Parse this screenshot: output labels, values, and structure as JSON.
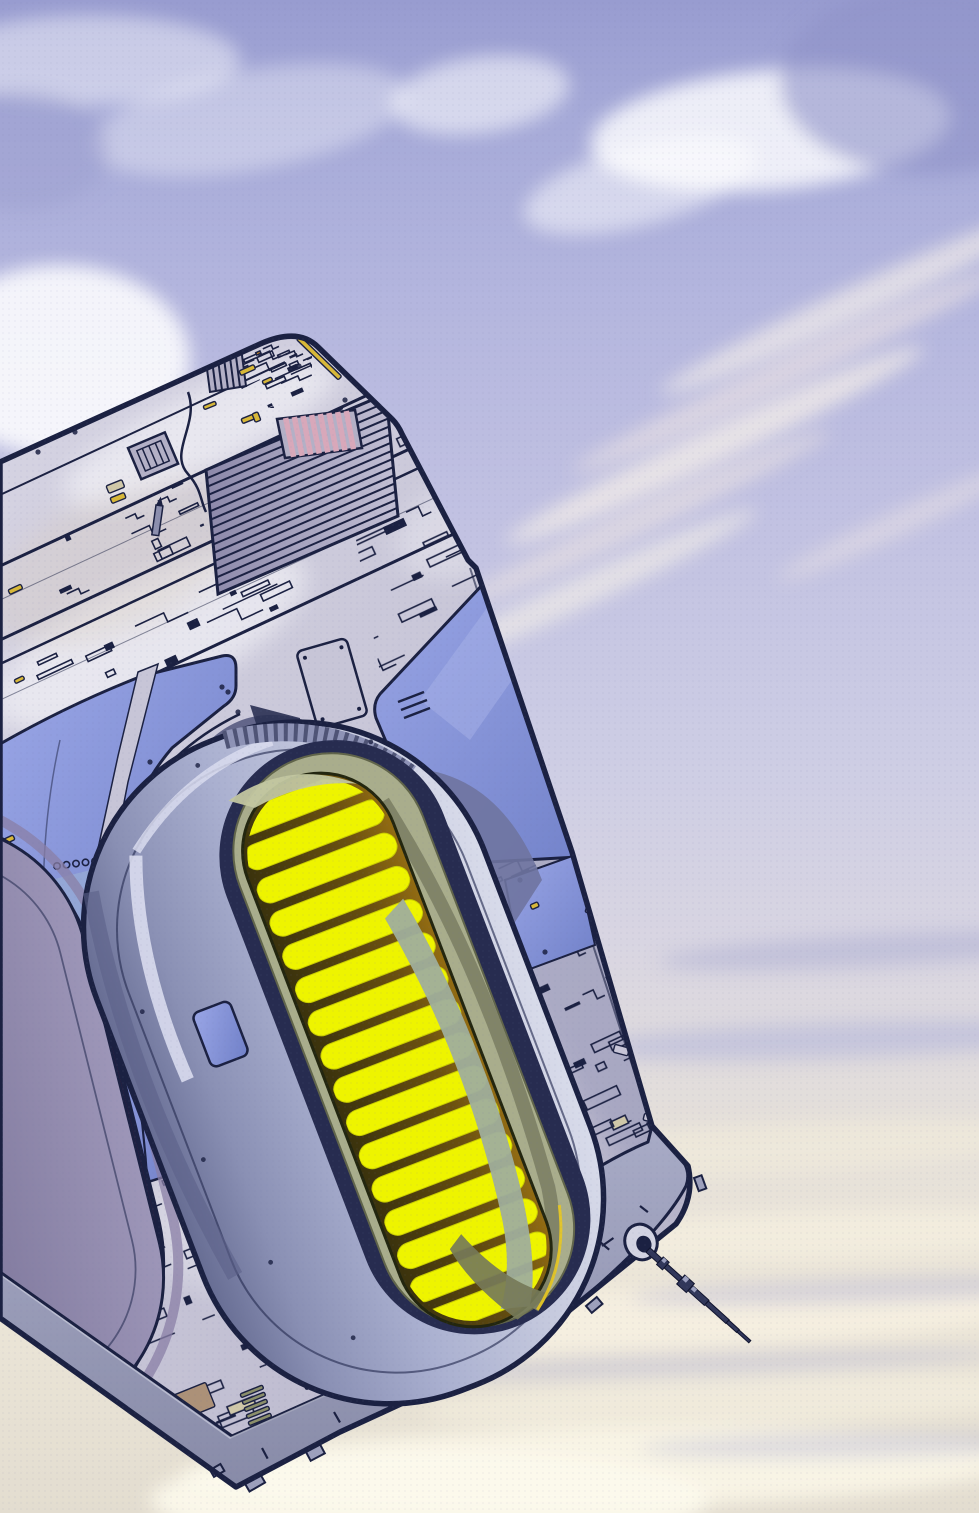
{
  "meta": {
    "title": "Comic splash illustration: massive greebled starship hull with glowing engine nacelles drifting in a lavender cloudy sky",
    "style": "printed-comic-halftone",
    "width": 979,
    "height": 1513
  },
  "palette": {
    "outline": "#1b2142",
    "navy": "#232a52",
    "hull_base": "#c7c5d7",
    "hull_light": "#d6d4e3",
    "hull_dark": "#b3b0c6",
    "side_face": "#9da0bc",
    "side_dark": "#8b8ea9",
    "blue_hi": "#9aa6e6",
    "blue_lo": "#7080c8",
    "teal_patch": "#9fb8d4",
    "pod_shell_l": "#676d93",
    "pod_shell_m": "#aab0d0",
    "pod_shell_r": "#d8dbea",
    "trim": "#d9dcee",
    "cavity": "#272c50",
    "olive": "#a9ad8c",
    "olive_dark": "#767a58",
    "sage": "#c2c6a0",
    "sage_grey": "#9fae9c",
    "gap_dark": "#3a320d",
    "gap_orange": "#936c12",
    "slat_yellow": "#eef400",
    "slat_edge": "#c9cc00",
    "lp_maroon": "#6f2136",
    "lp_gap": "#54101c",
    "lp_shell_1": "#6d6890",
    "lp_shell_2": "#9d96b8",
    "lp_band": "#8a7fa6",
    "slat_gold_1": "#f6cf2a",
    "slat_gold_2": "#e08a14",
    "mauve_1": "#b05878",
    "mauve_2": "#7e3560",
    "gold": "#d8b838",
    "tan": "#cfc7a8",
    "tan_brown": "#ac9178",
    "orange": "#dd8f1c",
    "magenta": "#c535c5",
    "pink_vent": "#d8a8ba",
    "olive_vent": "#8b8f6a",
    "sky_top": "#989cd0",
    "cream": "#efe9d8",
    "glint_yellow": "#e8c820"
  },
  "sky": {
    "gradient": [
      [
        "0",
        "#989cd0"
      ],
      [
        "0.08",
        "#a6aad8"
      ],
      [
        "0.2",
        "#b4b6de"
      ],
      [
        "0.35",
        "#c2c2e2"
      ],
      [
        "0.5",
        "#cdcde4"
      ],
      [
        "0.62",
        "#d8d5e2"
      ],
      [
        "0.74",
        "#e4dfda"
      ],
      [
        "0.85",
        "#ece6d8"
      ],
      [
        "1",
        "#e3ddd0"
      ]
    ],
    "clouds": [
      [
        90,
        60,
        150,
        45,
        0,
        "#ffffff",
        0.45
      ],
      [
        250,
        120,
        160,
        50,
        -10,
        "#ffffff",
        0.35
      ],
      [
        480,
        95,
        90,
        38,
        -8,
        "#ffffff",
        0.55
      ],
      [
        770,
        130,
        180,
        60,
        -5,
        "#ffffff",
        0.8
      ],
      [
        640,
        185,
        120,
        40,
        -15,
        "#ffffff",
        0.5
      ],
      [
        60,
        360,
        130,
        95,
        0,
        "#ffffff",
        0.85
      ],
      [
        160,
        560,
        200,
        130,
        0,
        "#ffffff",
        0.9
      ],
      [
        40,
        720,
        180,
        140,
        0,
        "#ffffff",
        0.95
      ],
      [
        930,
        80,
        150,
        95,
        0,
        "#8f93c8",
        0.6
      ],
      [
        20,
        150,
        90,
        60,
        0,
        "#9da0d0",
        0.5
      ],
      [
        860,
        300,
        220,
        16,
        -25,
        "#f4eeea",
        0.7
      ],
      [
        790,
        370,
        240,
        14,
        -25,
        "#f1e7e4",
        0.6
      ],
      [
        715,
        445,
        230,
        17,
        -25,
        "#f6efe8",
        0.75
      ],
      [
        640,
        520,
        210,
        13,
        -25,
        "#efe6e2",
        0.6
      ],
      [
        575,
        595,
        200,
        15,
        -25,
        "#f4efe8",
        0.65
      ],
      [
        905,
        520,
        140,
        12,
        -25,
        "#eee6e6",
        0.5
      ],
      [
        880,
        950,
        220,
        16,
        -3,
        "#aeb0d4",
        0.55
      ],
      [
        840,
        1040,
        260,
        18,
        -2,
        "#b6b7da",
        0.6
      ],
      [
        760,
        1150,
        300,
        26,
        -3,
        "#efe9da",
        0.85
      ],
      [
        820,
        1235,
        280,
        24,
        -2,
        "#f3edde",
        0.9
      ],
      [
        650,
        1320,
        380,
        30,
        -2,
        "#f5efe0",
        0.95
      ],
      [
        750,
        1400,
        330,
        26,
        -2,
        "#f1ebdc",
        0.9
      ],
      [
        600,
        1468,
        420,
        40,
        -1,
        "#f9f4e6",
        0.95
      ],
      [
        870,
        1290,
        240,
        12,
        -2,
        "#b7b7d4",
        0.5
      ],
      [
        700,
        1365,
        300,
        12,
        -2,
        "#c0c0d8",
        0.5
      ],
      [
        860,
        1445,
        220,
        12,
        -1,
        "#bcbcd4",
        0.45
      ],
      [
        430,
        1500,
        280,
        50,
        0,
        "#fdf9ec",
        0.9
      ]
    ]
  },
  "ship": {
    "tilt_deg": -25,
    "sheens": [
      [
        150,
        640,
        170,
        60,
        -25,
        "#ffffff",
        0.5
      ],
      [
        85,
        1075,
        45,
        120,
        -20,
        "#ffffff",
        0.45
      ],
      [
        330,
        900,
        160,
        80,
        -25,
        "#9093bb",
        0.32
      ],
      [
        120,
        560,
        140,
        70,
        -25,
        "#d8cdc2",
        0.38
      ],
      [
        200,
        432,
        150,
        38,
        -25,
        "#ffffff",
        0.5
      ],
      [
        590,
        990,
        60,
        220,
        -24,
        "#8487ad",
        0.35
      ],
      [
        260,
        1200,
        120,
        90,
        -22,
        "#eceaf2",
        0.4
      ],
      [
        480,
        520,
        90,
        50,
        -25,
        "#ffffff",
        0.3
      ]
    ],
    "louver": {
      "pts": [
        [
          206,
          470
        ],
        [
          386,
          394
        ],
        [
          398,
          516
        ],
        [
          218,
          594
        ]
      ],
      "ribs": 15
    },
    "pink_vent": {
      "pts": [
        [
          277,
          419
        ],
        [
          355,
          410
        ],
        [
          362,
          448
        ],
        [
          285,
          458
        ]
      ],
      "stripes": 9,
      "stroke_w": 5.5
    },
    "corner_grill": {
      "pts": [
        [
          204,
          346
        ],
        [
          240,
          340
        ],
        [
          246,
          386
        ],
        [
          210,
          392
        ]
      ],
      "stripes": 6
    },
    "greeble_fields": [
      {
        "name": "corner-cluster",
        "clip": [
          [
            222,
            338
          ],
          [
            312,
            338
          ],
          [
            312,
            408
          ],
          [
            222,
            408
          ]
        ],
        "bbox": [
          222,
          338,
          90,
          70
        ],
        "angle": -24,
        "n": 28,
        "seed": 7,
        "scale": 0.55,
        "accent_p": 0.12
      },
      {
        "name": "trench-a",
        "clip": [
          [
            0,
            566
          ],
          [
            430,
            366
          ],
          [
            446,
            432
          ],
          [
            0,
            640
          ]
        ],
        "bbox": [
          0,
          350,
          460,
          300
        ],
        "angle": -25,
        "n": 120,
        "seed": 11,
        "scale": 0.8,
        "accent_p": 0.04
      },
      {
        "name": "trench-b",
        "clip": [
          [
            0,
            664
          ],
          [
            470,
            444
          ],
          [
            520,
            503
          ],
          [
            0,
            746
          ]
        ],
        "bbox": [
          0,
          430,
          530,
          330
        ],
        "angle": -25,
        "n": 115,
        "seed": 23,
        "scale": 1,
        "accent_p": 0.05
      },
      {
        "name": "right-strip",
        "clip": [
          [
            342,
            462
          ],
          [
            470,
            402
          ],
          [
            600,
            760
          ],
          [
            672,
            1150
          ],
          [
            692,
            1212
          ],
          [
            532,
            1292
          ],
          [
            470,
            1140
          ],
          [
            404,
            806
          ]
        ],
        "bbox": [
          340,
          400,
          360,
          900
        ],
        "angle": -25,
        "n": 300,
        "seed": 37,
        "scale": 0.9,
        "accent_p": 0.03
      },
      {
        "name": "mid-low",
        "clip": [
          [
            95,
            1035
          ],
          [
            230,
            985
          ],
          [
            330,
            1105
          ],
          [
            360,
            1240
          ],
          [
            390,
            1340
          ],
          [
            210,
            1448
          ],
          [
            115,
            1310
          ]
        ],
        "bbox": [
          90,
          980,
          310,
          480
        ],
        "angle": -22,
        "n": 110,
        "seed": 41,
        "scale": 1,
        "accent_p": 0.07
      },
      {
        "name": "left-low",
        "clip": [
          [
            0,
            886
          ],
          [
            120,
            820
          ],
          [
            165,
            960
          ],
          [
            60,
            1050
          ],
          [
            0,
            1050
          ]
        ],
        "bbox": [
          0,
          810,
          170,
          250
        ],
        "angle": -25,
        "n": 42,
        "seed": 13,
        "scale": 0.9,
        "accent_p": 0.05
      },
      {
        "name": "left-edge",
        "clip": [
          [
            0,
            960
          ],
          [
            75,
            935
          ],
          [
            95,
            1035
          ],
          [
            0,
            1090
          ]
        ],
        "bbox": [
          0,
          930,
          100,
          170
        ],
        "angle": -22,
        "n": 26,
        "seed": 17,
        "scale": 0.8,
        "accent_p": 0.06
      },
      {
        "name": "top-face-sparse",
        "clip": [
          [
            60,
            430
          ],
          [
            280,
            330
          ],
          [
            300,
            360
          ],
          [
            80,
            470
          ]
        ],
        "bbox": [
          60,
          330,
          250,
          150
        ],
        "angle": -24,
        "n": 10,
        "seed": 29,
        "scale": 0.7,
        "accent_p": 0.1
      }
    ],
    "accents": [
      [
        300,
        336,
        58,
        5,
        44,
        "#d8b838"
      ],
      [
        239,
        371,
        16,
        5,
        -24,
        "#d8b838"
      ],
      [
        262,
        381,
        10,
        4,
        -24,
        "#d8b838"
      ],
      [
        203,
        406,
        13,
        4,
        -22,
        "#d8b838"
      ],
      [
        241,
        419,
        13,
        5,
        -22,
        "#d8b838"
      ],
      [
        252,
        414,
        6,
        9,
        -22,
        "#d8b838"
      ],
      [
        106,
        486,
        17,
        8,
        -22,
        "#cfc7a8"
      ],
      [
        110,
        498,
        15,
        6,
        -22,
        "#d8b838"
      ],
      [
        8,
        590,
        14,
        5,
        -25,
        "#d8b838"
      ],
      [
        14,
        680,
        10,
        4,
        -25,
        "#d8b838"
      ],
      [
        2,
        840,
        12,
        5,
        -25,
        "#d8b838"
      ],
      [
        60,
        1306,
        6,
        26,
        12,
        "#dd8f1c"
      ],
      [
        71,
        1298,
        5,
        22,
        14,
        "#dd8f1c"
      ],
      [
        84,
        1316,
        5,
        20,
        12,
        "#d8b838"
      ],
      [
        124,
        1362,
        5,
        26,
        -15,
        "#d8b838"
      ],
      [
        133,
        1376,
        4,
        30,
        -15,
        "#dd8f1c"
      ],
      [
        142,
        1392,
        4,
        24,
        -15,
        "#d8b838"
      ],
      [
        166,
        1427,
        11,
        8,
        -20,
        "#c535c5"
      ],
      [
        178,
        1437,
        9,
        7,
        -20,
        "#c535c5"
      ],
      [
        174,
        1395,
        34,
        26,
        -22,
        "#ac9178"
      ],
      [
        300,
        1376,
        30,
        15,
        -24,
        "#cfc7a8"
      ],
      [
        530,
        905,
        8,
        5,
        -24,
        "#d8b838"
      ],
      [
        548,
        1238,
        6,
        4,
        -30,
        "#d8b838"
      ],
      [
        240,
        1394,
        24,
        4,
        -22,
        "#8b8f6a"
      ],
      [
        242,
        1401,
        24,
        4,
        -22,
        "#8b8f6a"
      ],
      [
        244,
        1408,
        24,
        4,
        -22,
        "#8b8f6a"
      ],
      [
        246,
        1415,
        24,
        4,
        -22,
        "#8b8f6a"
      ],
      [
        248,
        1422,
        24,
        4,
        -22,
        "#8b8f6a"
      ],
      [
        250,
        1429,
        24,
        4,
        -22,
        "#8b8f6a"
      ],
      [
        585,
        912,
        9,
        16,
        -73,
        "hull"
      ],
      [
        613,
        1052,
        8,
        15,
        -75,
        "hull"
      ],
      [
        643,
        1120,
        7,
        13,
        -76,
        "hull"
      ]
    ],
    "rivets": [
      [
        185,
        347
      ],
      [
        252,
        339
      ],
      [
        299,
        366
      ],
      [
        345,
        400
      ],
      [
        75,
        432
      ],
      [
        38,
        452
      ],
      [
        222,
        687
      ],
      [
        228,
        692
      ],
      [
        150,
        762
      ],
      [
        98,
        878
      ],
      [
        128,
        1040
      ],
      [
        92,
        1182
      ],
      [
        238,
        712
      ],
      [
        196,
        753
      ],
      [
        642,
        1160
      ],
      [
        624,
        1190
      ],
      [
        605,
        1218
      ],
      [
        520,
        880
      ],
      [
        545,
        952
      ],
      [
        120,
        1368
      ],
      [
        260,
        1452
      ],
      [
        330,
        1408
      ],
      [
        560,
        1282
      ],
      [
        600,
        1250
      ]
    ],
    "scallops": {
      "x": 57,
      "y": 866,
      "n": 7,
      "dx": 9.5,
      "dy": -1.2,
      "r": 3.2
    },
    "ticks": [
      [
        262,
        1448,
        12,
        62
      ],
      [
        334,
        1412,
        12,
        60
      ],
      [
        424,
        1368,
        12,
        58
      ],
      [
        600,
        1242,
        12,
        40
      ],
      [
        640,
        1206,
        10,
        38
      ],
      [
        566,
        1270,
        14,
        -35
      ],
      [
        584,
        1258,
        14,
        -35
      ],
      [
        602,
        1246,
        14,
        -35
      ]
    ],
    "tabs": [
      [
        244,
        1482,
        18,
        11,
        -30
      ],
      [
        306,
        1452,
        16,
        10,
        -28
      ],
      [
        586,
        1306,
        14,
        9,
        -40
      ],
      [
        694,
        1178,
        8,
        14,
        -20
      ],
      [
        210,
        1470,
        12,
        8,
        -30
      ]
    ]
  },
  "engines": {
    "main": {
      "cx": 372,
      "cy": 1052,
      "rot": -21,
      "slats": {
        "count": 16,
        "x": -50,
        "w": 148,
        "h": 26,
        "rx": 13,
        "y0": -272,
        "step": 35.6
      },
      "clip": [
        -50,
        -278,
        148,
        570,
        74
      ]
    },
    "left": {
      "cx": -30,
      "cy": 1128,
      "rot": -14,
      "slats": {
        "count": 24,
        "x": -224,
        "w": 368,
        "h": 16,
        "rx": 8,
        "y0": -300,
        "step": 24
      },
      "clip": [
        -224,
        -314,
        368,
        628,
        186
      ]
    }
  },
  "antenna": {
    "x": 648,
    "y": 1250,
    "rot": 42,
    "segments": [
      [
        0,
        -3,
        16,
        6
      ],
      [
        16,
        -5,
        8,
        10
      ],
      [
        24,
        -2.5,
        20,
        5
      ],
      [
        44,
        -6,
        13,
        12
      ],
      [
        57,
        -3.5,
        22,
        7
      ],
      [
        79,
        -2.5,
        28,
        5
      ],
      [
        107,
        -2,
        14,
        4
      ],
      [
        121,
        -1.5,
        16,
        3
      ]
    ],
    "highlights": [
      [
        17,
        -5,
        4,
        4
      ],
      [
        45,
        -6,
        5,
        5
      ],
      [
        58,
        -3.5,
        5,
        4
      ]
    ],
    "socket": {
      "x": 641,
      "y": 1242,
      "rx": 16,
      "ry": 18,
      "rot": -20
    }
  }
}
